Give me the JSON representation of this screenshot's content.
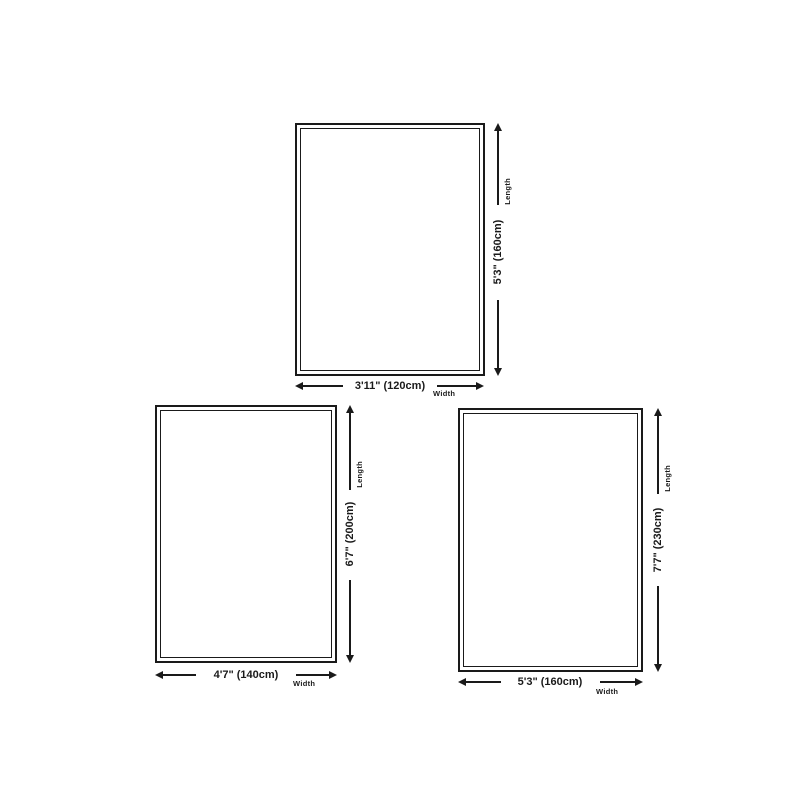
{
  "page": {
    "background_color": "#ffffff",
    "line_color": "#1a1a1a"
  },
  "rugs": [
    {
      "id": "rug-size-small",
      "width_label": "3'11\" (120cm)",
      "length_label": "5'3\" (160cm)",
      "width_caption": "Width",
      "length_caption": "Length"
    },
    {
      "id": "rug-size-medium",
      "width_label": "4'7\" (140cm)",
      "length_label": "6'7\" (200cm)",
      "width_caption": "Width",
      "length_caption": "Length"
    },
    {
      "id": "rug-size-large",
      "width_label": "5'3\" (160cm)",
      "length_label": "7'7\" (230cm)",
      "width_caption": "Width",
      "length_caption": "Length"
    }
  ]
}
